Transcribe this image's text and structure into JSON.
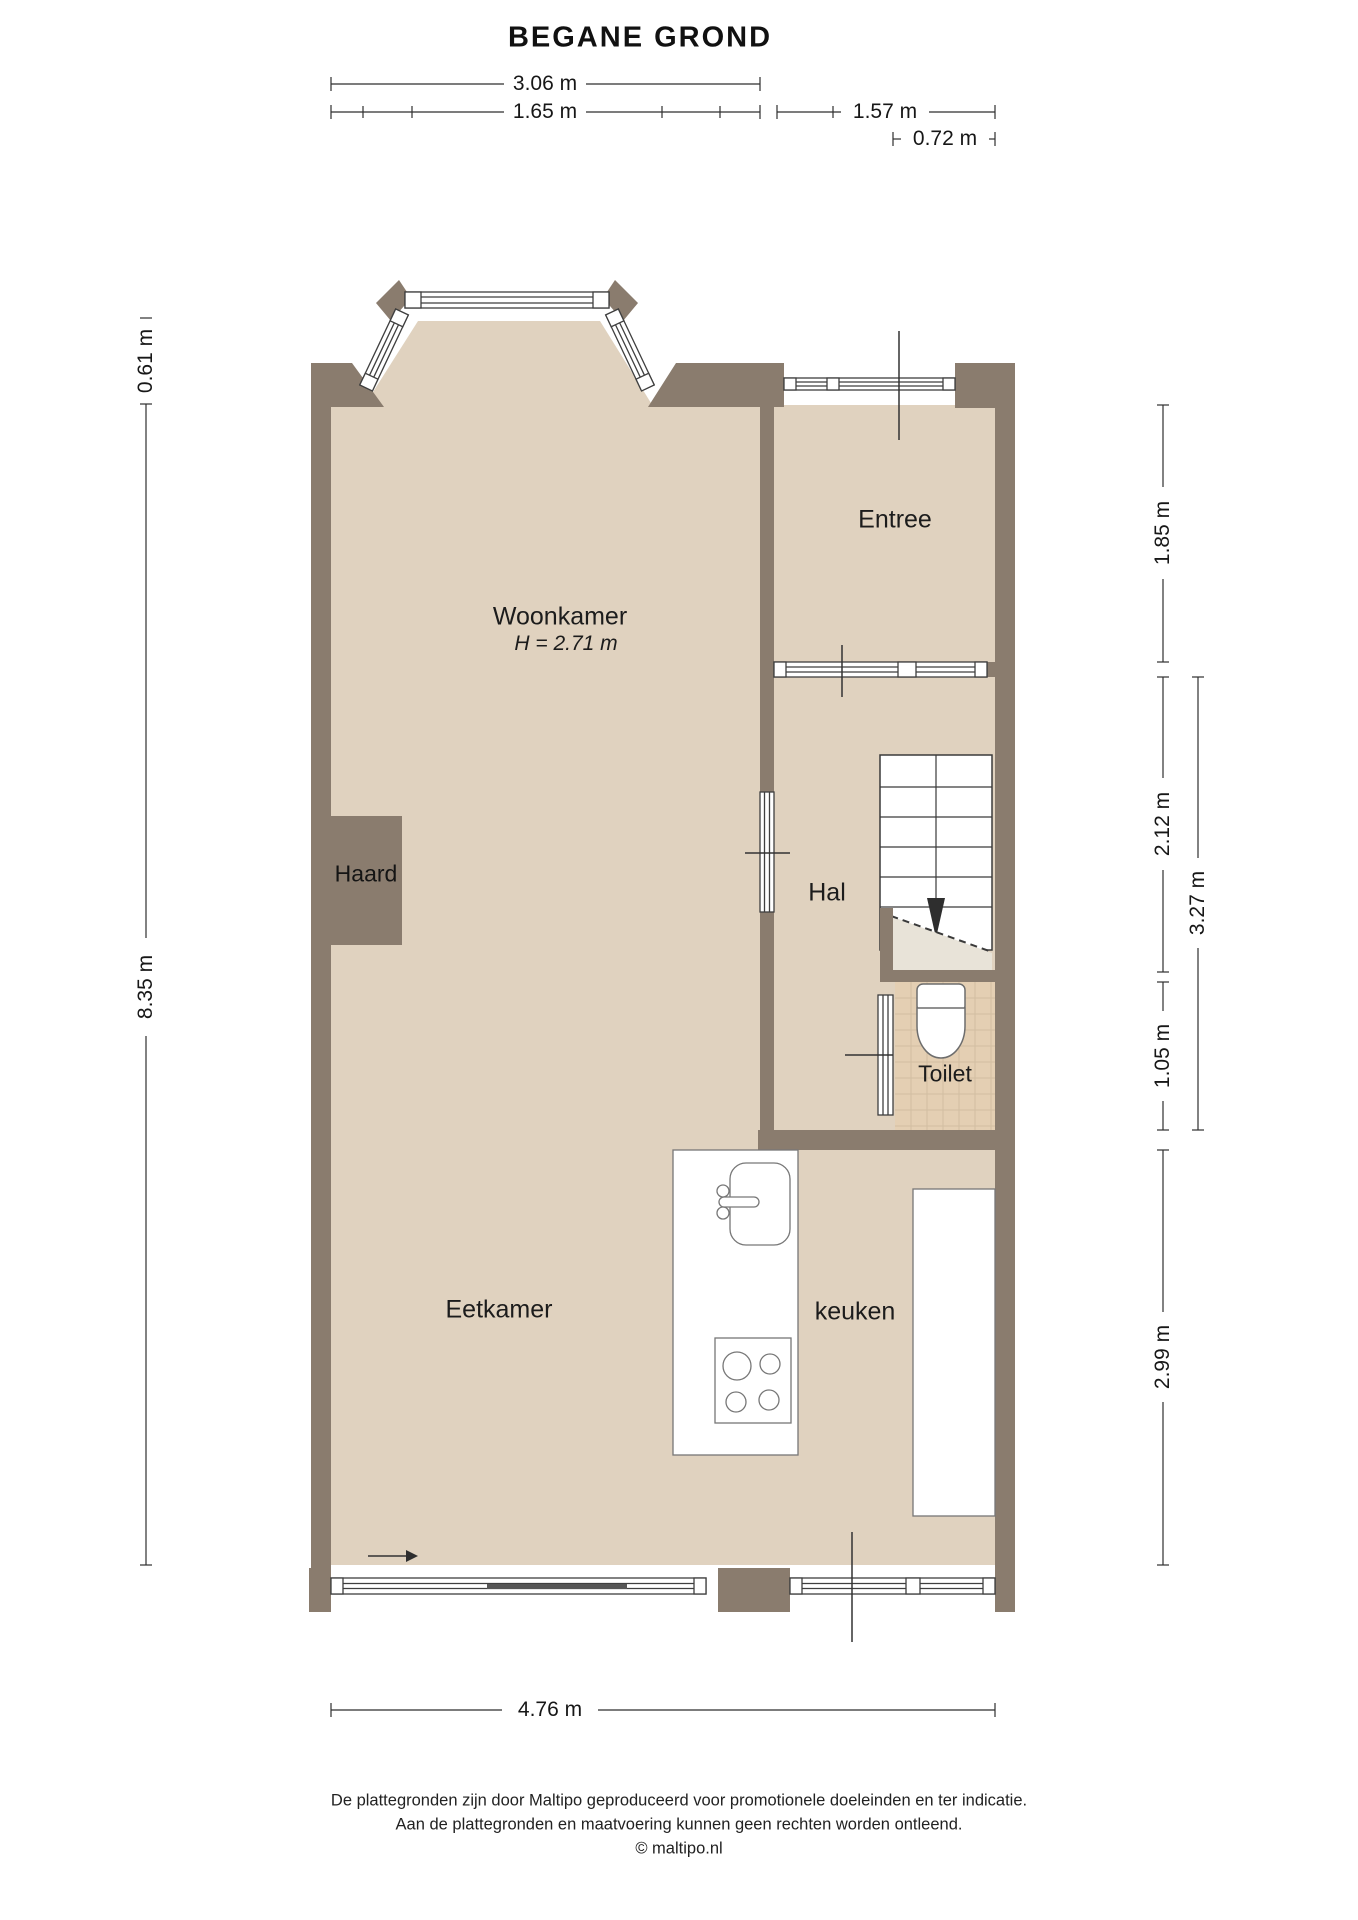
{
  "title": "BEGANE GROND",
  "rooms": {
    "woonkamer": {
      "label": "Woonkamer",
      "ceiling": "H = 2.71 m"
    },
    "entree": {
      "label": "Entree"
    },
    "hal": {
      "label": "Hal"
    },
    "haard": {
      "label": "Haard"
    },
    "toilet": {
      "label": "Toilet"
    },
    "eetkamer": {
      "label": "Eetkamer"
    },
    "keuken": {
      "label": "keuken"
    }
  },
  "dimensions": {
    "top": [
      {
        "label": "3.06 m"
      },
      {
        "label": "1.65 m"
      },
      {
        "label": "1.57 m"
      },
      {
        "label": "0.72 m"
      }
    ],
    "left": [
      {
        "label": "0.61 m"
      },
      {
        "label": "8.35 m"
      }
    ],
    "right": [
      {
        "label": "1.85 m"
      },
      {
        "label": "2.12 m"
      },
      {
        "label": "3.27 m"
      },
      {
        "label": "1.05 m"
      },
      {
        "label": "2.99 m"
      }
    ],
    "bottom": [
      {
        "label": "4.76 m"
      }
    ]
  },
  "footer": {
    "line1": "De plattegronden zijn door Maltipo geproduceerd voor promotionele doeleinden en ter indicatie.",
    "line2": "Aan de plattegronden en maatvoering kunnen geen rechten worden ontleend.",
    "line3": "© maltipo.nl"
  },
  "colors": {
    "floor": "#e0d2bf",
    "wall": "#8a7c6e",
    "toilet-floor": "#e4cfb3",
    "tile-line": "#d2bda1",
    "understair": "#e8e3d8"
  }
}
